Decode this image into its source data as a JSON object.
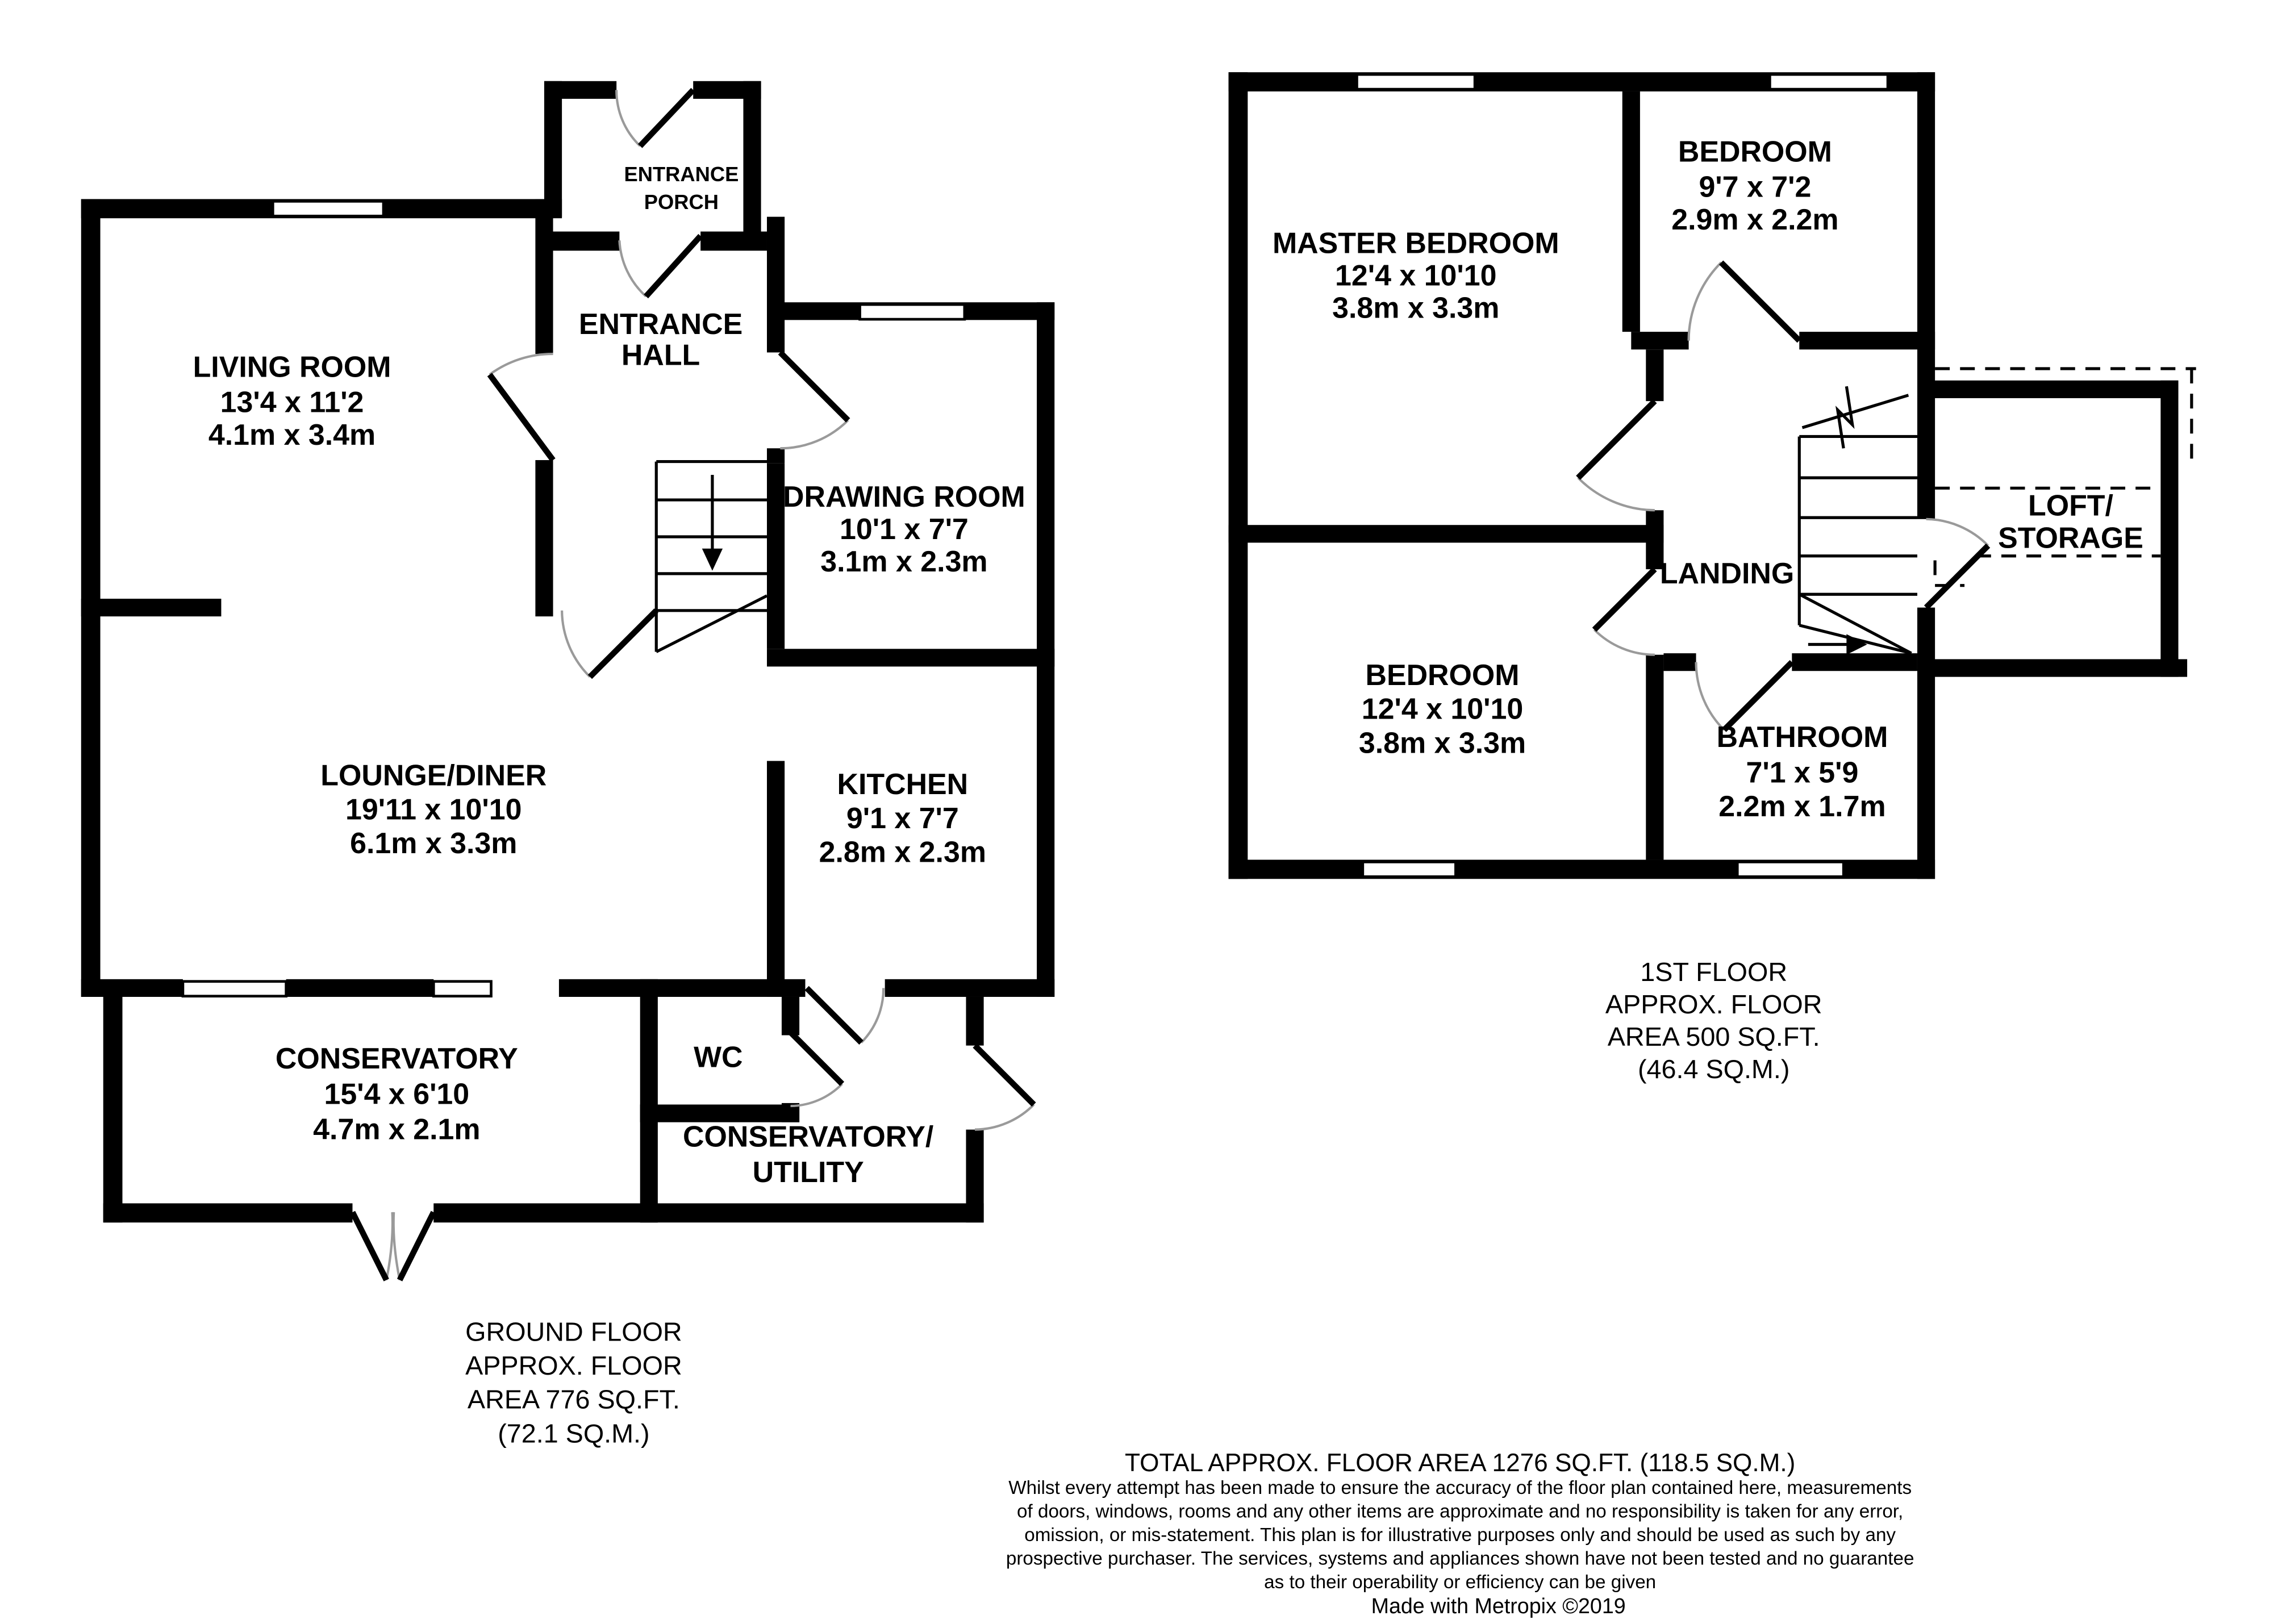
{
  "ground_floor": {
    "rooms": {
      "living_room": {
        "name": "LIVING ROOM",
        "dims_ft": "13'4 x 11'2",
        "dims_m": "4.1m x 3.4m"
      },
      "entrance_porch": {
        "line1": "ENTRANCE",
        "line2": "PORCH"
      },
      "entrance_hall": {
        "line1": "ENTRANCE",
        "line2": "HALL"
      },
      "drawing_room": {
        "name": "DRAWING ROOM",
        "dims_ft": "10'1 x 7'7",
        "dims_m": "3.1m x 2.3m"
      },
      "lounge_diner": {
        "name": "LOUNGE/DINER",
        "dims_ft": "19'11 x 10'10",
        "dims_m": "6.1m x 3.3m"
      },
      "kitchen": {
        "name": "KITCHEN",
        "dims_ft": "9'1 x 7'7",
        "dims_m": "2.8m x 2.3m"
      },
      "conservatory": {
        "name": "CONSERVATORY",
        "dims_ft": "15'4 x 6'10",
        "dims_m": "4.7m x 2.1m"
      },
      "wc": {
        "name": "WC"
      },
      "conservatory_utility": {
        "line1": "CONSERVATORY/",
        "line2": "UTILITY"
      }
    },
    "caption": {
      "line1": "GROUND FLOOR",
      "line2": "APPROX. FLOOR",
      "line3": "AREA 776 SQ.FT.",
      "line4": "(72.1 SQ.M.)"
    }
  },
  "first_floor": {
    "rooms": {
      "master_bedroom": {
        "name": "MASTER BEDROOM",
        "dims_ft": "12'4 x 10'10",
        "dims_m": "3.8m x 3.3m"
      },
      "bedroom_top": {
        "name": "BEDROOM",
        "dims_ft": "9'7 x 7'2",
        "dims_m": "2.9m x 2.2m"
      },
      "landing": {
        "name": "LANDING"
      },
      "loft_storage": {
        "line1": "LOFT/",
        "line2": "STORAGE"
      },
      "bedroom_bottom": {
        "name": "BEDROOM",
        "dims_ft": "12'4 x 10'10",
        "dims_m": "3.8m x 3.3m"
      },
      "bathroom": {
        "name": "BATHROOM",
        "dims_ft": "7'1 x 5'9",
        "dims_m": "2.2m x 1.7m"
      }
    },
    "caption": {
      "line1": "1ST FLOOR",
      "line2": "APPROX. FLOOR",
      "line3": "AREA 500 SQ.FT.",
      "line4": "(46.4 SQ.M.)"
    }
  },
  "footer": {
    "total_area": "TOTAL APPROX. FLOOR AREA 1276 SQ.FT. (118.5 SQ.M.)",
    "disclaimer_line1": "Whilst every attempt has been made to ensure the accuracy of the floor plan contained here, measurements",
    "disclaimer_line2": "of doors, windows, rooms and any other items are approximate and no responsibility is taken for any error,",
    "disclaimer_line3": "omission, or mis-statement. This plan is for illustrative purposes only and should be used as such by any",
    "disclaimer_line4": "prospective purchaser. The services, systems and appliances shown have not been tested and no guarantee",
    "disclaimer_line5": "as to their operability or efficiency can be given",
    "credit": "Made with Metropix ©2019"
  }
}
